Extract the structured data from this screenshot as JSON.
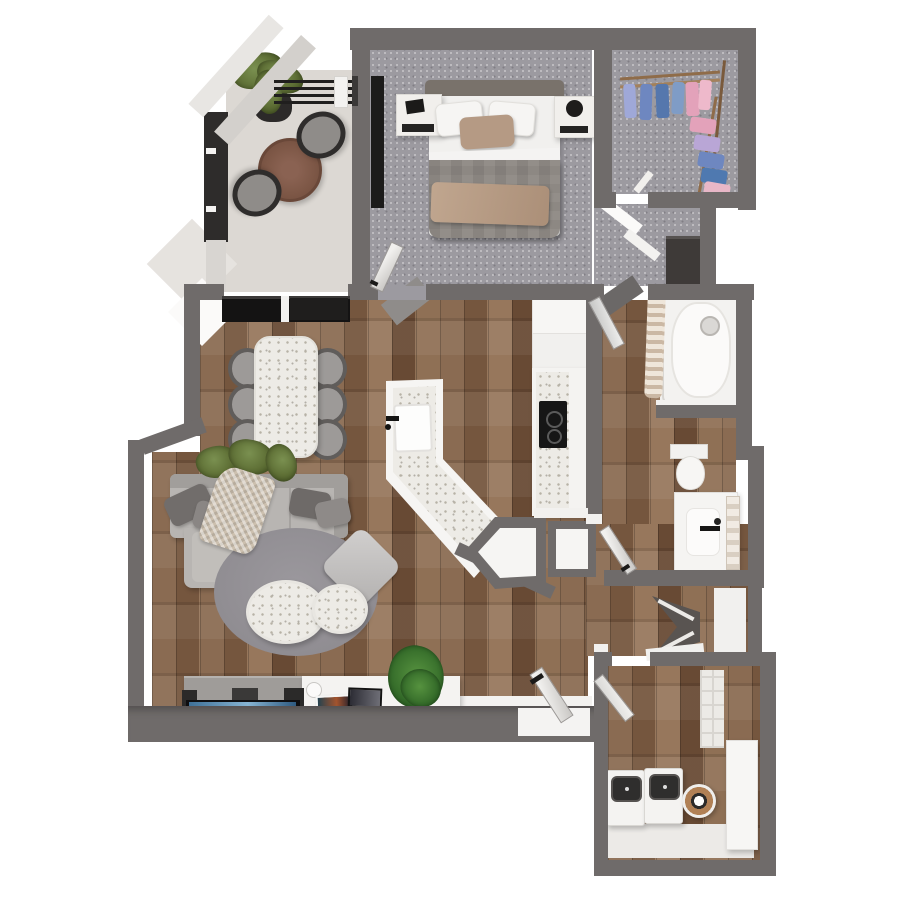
{
  "meta": {
    "type": "3d-floor-plan-render",
    "view": "top-down bird's-eye",
    "description": "Photoreal 3D rendering of a one-bedroom apartment floor plan on a white background"
  },
  "palette": {
    "wall": "#6f6b6a",
    "wall_dark": "#2e2c2b",
    "wood_a": "#8a6b52",
    "wood_b": "#75563e",
    "wood_c": "#97775c",
    "wood_d": "#684a34",
    "wood_e": "#8f7055",
    "carpet": "#9c9aa0",
    "balcony_floor": "#dcd8d3",
    "terrazzo": "#edebe6",
    "terrazzo_dot": "#b7b2a6",
    "white_surface": "#f4f3f1",
    "sofa": "#b8b5b2",
    "sofa_dark": "#a19e9b",
    "pillow_dark": "#716d6b",
    "rug": "#97949a",
    "headboard": "#79726b",
    "bed_duvet": "#8d8883",
    "bed_throw": "#b59a84",
    "tv_screen": "#3f7198",
    "tv_screen_light": "#86b4d2",
    "plant_green": "#5f7036",
    "plant_green_dark": "#465522",
    "fern_green": "#2f6526",
    "wood_table": "#7d5746",
    "cooktop": "#161616",
    "clothes": [
      "#9fa8d8",
      "#6e87c0",
      "#5577ad",
      "#7f9cc6",
      "#e3a2ba",
      "#eeb9cb",
      "#b9a6d6",
      "#4f79b0",
      "#e8b7c7"
    ]
  },
  "rooms": {
    "balcony": {
      "label": "Balcony",
      "items": [
        "round wood bistro table",
        "patio chair (2)",
        "potted plant",
        "angled privacy screens",
        "black railing",
        "dark privacy wall"
      ]
    },
    "bedroom": {
      "label": "Bedroom",
      "items": [
        "queen bed with gray duvet and tan throw",
        "white pillows (2)",
        "tan accent pillow",
        "marble nightstand with frame",
        "marble nightstand with sphere lamp",
        "wall-mounted TV",
        "door"
      ]
    },
    "walk_in_closet": {
      "label": "Walk-in closet",
      "items": [
        "wood clothing racks",
        "hanging clothes in blue, light blue, lavender and pink"
      ]
    },
    "hallway": {
      "label": "Hallway",
      "items": [
        "dark linen cabinet",
        "cased openings"
      ]
    },
    "bathroom": {
      "label": "Bathroom",
      "items": [
        "bathtub",
        "shower curtain",
        "shower head",
        "pony wall",
        "toilet",
        "vanity with sink and black faucet",
        "towel ladder",
        "door to hall (2)"
      ]
    },
    "living_dining_kitchen": {
      "label": "Open living / dining / kitchen",
      "items": [
        "terrazzo dining table",
        "dining chair (6)",
        "angled kitchen island with sink and black faucet",
        "counter run with cooktop",
        "refrigerator / tall cabinets",
        "sectional sofa with chaise",
        "dark throw pillows",
        "knit throw blanket",
        "round area rug",
        "round terrazzo coffee table (2)",
        "gray floor cushion",
        "media console",
        "flat TV with blue screen",
        "speakers",
        "picture frames",
        "houseplants",
        "balcony sliding glass door"
      ]
    },
    "entry": {
      "label": "Entry",
      "items": [
        "front door with black handle",
        "angled pony wall",
        "white pony walls",
        "tile threshold"
      ]
    },
    "laundry": {
      "label": "Laundry / storage",
      "items": [
        "washer",
        "dryer",
        "water heater",
        "wall shelving",
        "storage cabinet",
        "door"
      ]
    },
    "nook": {
      "label": "Storage nook",
      "items": [
        "corner shelf unit",
        "white shelf board"
      ]
    }
  }
}
